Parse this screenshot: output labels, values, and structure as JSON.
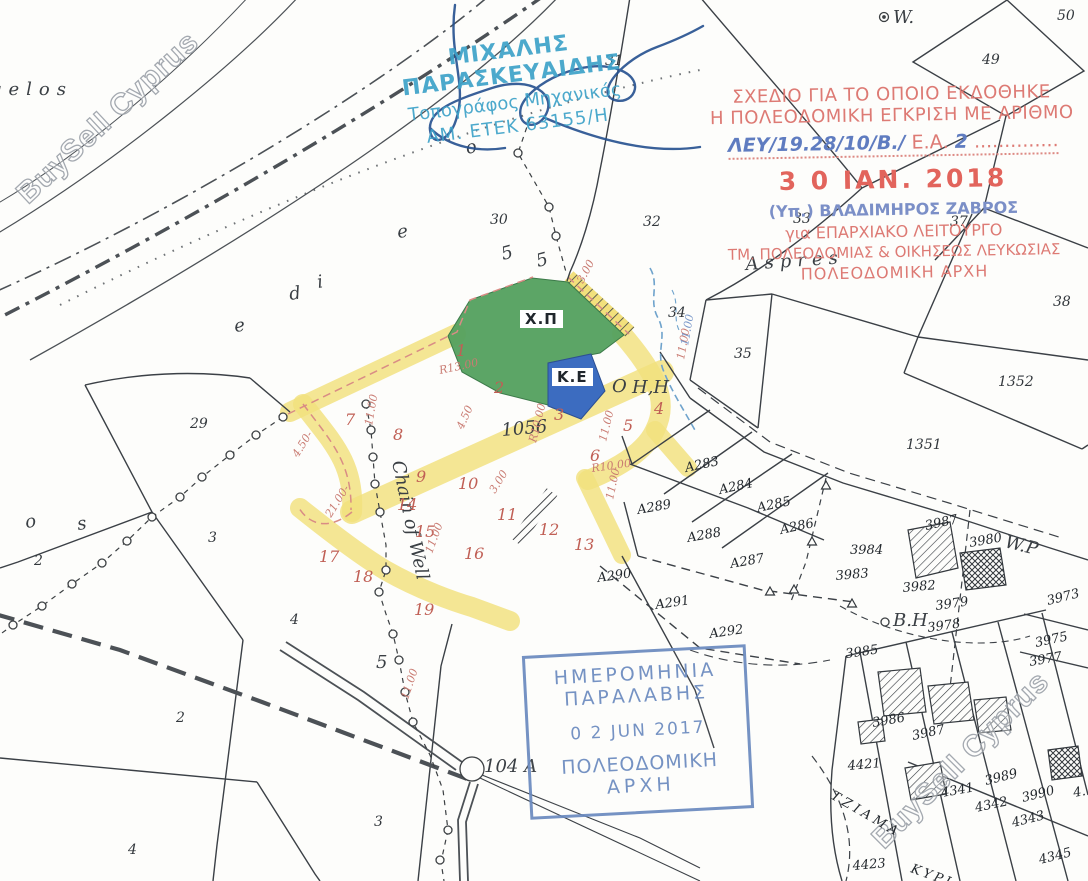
{
  "document_type": "cadastral-survey-plan",
  "watermarks": {
    "top_left": "BuySell Cyprus",
    "bottom_right": "BuySell Cyprus"
  },
  "surveyor_stamp": {
    "name": "ΜΙΧΑΛΗΣ ΠΑΡΑΣΚΕΥΑΙΔΗΣ",
    "title": "Τοπογράφος Μηχανικός",
    "registration": "ΑΜ. ΕΤΕΚ 63155/Η",
    "color": "#3ea2c9"
  },
  "approval_stamp": {
    "line1": "ΣΧΕΔΙΟ ΓΙΑ ΤΟ ΟΠΟΙΟ ΕΚΔΟΘΗΚΕ",
    "line2": "Η ΠΟΛΕΟΔΟΜΙΚΗ ΕΓΚΡΙΣΗ ΜΕ ΑΡΙΘΜΟ",
    "reference_handwritten": "ΛΕΥ/19.28/10/Β./",
    "reference_label": "Ε.Α.",
    "reference_number": "2",
    "reference_dots": "..............",
    "date": "3 0 ΙΑΝ. 2018",
    "signed_by": "(Υπ.) ΒΛΑΔΙΜΗΡΟΣ ΖΑΒΡΟΣ",
    "for_line": "για ΕΠΑΡΧΙΑΚΟ ΛΕΙΤΟΥΡΓΟ",
    "dept_line": "ΤΜ. ΠΟΛΕΟΔΟΜΙΑΣ & ΟΙΚΗΣΕΩΣ ΛΕΥΚΩΣΙΑΣ",
    "authority": "ΠΟΛΕΟΔΟΜΙΚΗ ΑΡΧΗ",
    "red": "#dd7a74",
    "blue": "#7b8fc7"
  },
  "receipt_stamp": {
    "line1": "ΗΜΕΡΟΜΗΝΙΑ",
    "line2": "ΠΑΡΑΛΑΒΗΣ",
    "date": "0 2 JUN 2017",
    "line3": "ΠΟΛΕΟΔΟΜΙΚΗ",
    "line4": "ΑΡΧΗ",
    "color": "#6a8abf"
  },
  "zones": {
    "green_label": "Χ.Π",
    "blue_label": "Κ.Ε",
    "green_color": "#53a05e",
    "blue_color": "#3c6cc0",
    "road_highlight_color": "#f2e07c",
    "plot_number_color": "#c05f55"
  },
  "map_labels": [
    {
      "text": "gelos",
      "x": -10,
      "y": 95,
      "cls": "name",
      "s": 23,
      "ls": 7
    },
    {
      "text": "o",
      "x": 26,
      "y": 528,
      "cls": "name",
      "rot": -8,
      "s": 20
    },
    {
      "text": "s",
      "x": 78,
      "y": 530,
      "cls": "name",
      "rot": -8,
      "s": 20
    },
    {
      "text": "e",
      "x": 235,
      "y": 332,
      "cls": "name",
      "rot": -8,
      "s": 19
    },
    {
      "text": "d",
      "x": 290,
      "y": 300,
      "cls": "name",
      "rot": -8,
      "s": 19
    },
    {
      "text": "i",
      "x": 318,
      "y": 288,
      "cls": "name",
      "rot": -8,
      "s": 17
    },
    {
      "text": "e",
      "x": 398,
      "y": 238,
      "cls": "name",
      "rot": -8,
      "s": 19
    },
    {
      "text": "o",
      "x": 467,
      "y": 154,
      "cls": "name",
      "rot": -12,
      "s": 19
    },
    {
      "text": "Aspres",
      "x": 746,
      "y": 270,
      "cls": "name",
      "rot": -4,
      "s": 21,
      "ls": 6
    },
    {
      "text": "1056",
      "x": 502,
      "y": 436,
      "cls": "name",
      "rot": -5,
      "s": 14
    },
    {
      "text": "Chain of Well",
      "x": 392,
      "y": 462,
      "cls": "name",
      "rot": 78,
      "s": 13
    },
    {
      "text": "104 A",
      "x": 484,
      "y": 772,
      "cls": "name",
      "s": 16
    },
    {
      "text": "W.",
      "x": 893,
      "y": 23,
      "cls": "name",
      "s": 14
    },
    {
      "text": "W.P",
      "x": 1004,
      "y": 547,
      "cls": "name",
      "rot": 14,
      "s": 12
    },
    {
      "text": "B.H",
      "x": 893,
      "y": 626,
      "cls": "name",
      "s": 11
    },
    {
      "text": "O",
      "x": 612,
      "y": 392,
      "cls": "name",
      "s": 17
    },
    {
      "text": "H,H",
      "x": 632,
      "y": 393,
      "cls": "name",
      "s": 12
    },
    {
      "text": "5",
      "x": 503,
      "y": 260,
      "cls": "name",
      "rot": -15,
      "s": 12
    },
    {
      "text": "5",
      "x": 538,
      "y": 267,
      "cls": "name",
      "rot": -15,
      "s": 12
    },
    {
      "text": "5",
      "x": 376,
      "y": 668,
      "cls": "name",
      "s": 13
    },
    {
      "text": "31",
      "x": 605,
      "y": 65,
      "cls": "blk",
      "s": 10
    },
    {
      "text": "50",
      "x": 1057,
      "y": 20,
      "cls": "blk",
      "s": 13
    },
    {
      "text": "49",
      "x": 982,
      "y": 64,
      "cls": "blk",
      "s": 15
    },
    {
      "text": "30",
      "x": 490,
      "y": 224,
      "cls": "blk"
    },
    {
      "text": "32",
      "x": 643,
      "y": 226,
      "cls": "blk"
    },
    {
      "text": "33",
      "x": 793,
      "y": 223,
      "cls": "blk",
      "s": 11
    },
    {
      "text": "37",
      "x": 950,
      "y": 226,
      "cls": "blk",
      "s": 11
    },
    {
      "text": "38",
      "x": 1053,
      "y": 306,
      "cls": "blk",
      "s": 13
    },
    {
      "text": "34",
      "x": 668,
      "y": 317,
      "cls": "blk",
      "s": 12
    },
    {
      "text": "35",
      "x": 734,
      "y": 358,
      "cls": "blk",
      "s": 15
    },
    {
      "text": "1352",
      "x": 998,
      "y": 386,
      "cls": "blk",
      "s": 15
    },
    {
      "text": "1351",
      "x": 906,
      "y": 449,
      "cls": "blk",
      "s": 14
    },
    {
      "text": "29",
      "x": 190,
      "y": 428,
      "cls": "blk"
    },
    {
      "text": "2",
      "x": 34,
      "y": 565,
      "cls": "blk",
      "s": 13
    },
    {
      "text": "3",
      "x": 208,
      "y": 542,
      "cls": "blk",
      "s": 13
    },
    {
      "text": "4",
      "x": 290,
      "y": 624,
      "cls": "blk",
      "s": 13
    },
    {
      "text": "2",
      "x": 176,
      "y": 722,
      "cls": "blk"
    },
    {
      "text": "3",
      "x": 374,
      "y": 826,
      "cls": "blk"
    },
    {
      "text": "4",
      "x": 128,
      "y": 854,
      "cls": "blk"
    },
    {
      "text": "1",
      "x": 456,
      "y": 356,
      "cls": "red"
    },
    {
      "text": "2",
      "x": 494,
      "y": 393,
      "cls": "red"
    },
    {
      "text": "3",
      "x": 554,
      "y": 420,
      "cls": "red"
    },
    {
      "text": "4",
      "x": 654,
      "y": 414,
      "cls": "red"
    },
    {
      "text": "5",
      "x": 623,
      "y": 431,
      "cls": "red"
    },
    {
      "text": "6",
      "x": 590,
      "y": 461,
      "cls": "red"
    },
    {
      "text": "7",
      "x": 345,
      "y": 425,
      "cls": "red"
    },
    {
      "text": "8",
      "x": 393,
      "y": 440,
      "cls": "red"
    },
    {
      "text": "9",
      "x": 416,
      "y": 482,
      "cls": "red"
    },
    {
      "text": "10",
      "x": 458,
      "y": 489,
      "cls": "red"
    },
    {
      "text": "11",
      "x": 497,
      "y": 520,
      "cls": "red"
    },
    {
      "text": "12",
      "x": 539,
      "y": 535,
      "cls": "red"
    },
    {
      "text": "13",
      "x": 574,
      "y": 550,
      "cls": "red"
    },
    {
      "text": "14",
      "x": 397,
      "y": 510,
      "cls": "red"
    },
    {
      "text": "15",
      "x": 415,
      "y": 537,
      "cls": "red"
    },
    {
      "text": "16",
      "x": 464,
      "y": 559,
      "cls": "red"
    },
    {
      "text": "17",
      "x": 319,
      "y": 562,
      "cls": "red"
    },
    {
      "text": "18",
      "x": 353,
      "y": 582,
      "cls": "red"
    },
    {
      "text": "19",
      "x": 414,
      "y": 615,
      "cls": "red"
    },
    {
      "text": "R13.00",
      "x": 440,
      "y": 374,
      "cls": "dim",
      "rot": -12
    },
    {
      "text": "R10.00",
      "x": 536,
      "y": 443,
      "cls": "dim",
      "rot": -76
    },
    {
      "text": "3.00",
      "x": 583,
      "y": 284,
      "cls": "dim",
      "rot": -62
    },
    {
      "text": "11.00",
      "x": 684,
      "y": 360,
      "cls": "dim",
      "rot": -80
    },
    {
      "text": "4.50",
      "x": 463,
      "y": 430,
      "cls": "dim",
      "rot": -66
    },
    {
      "text": "4.50-",
      "x": 298,
      "y": 458,
      "cls": "dim",
      "rot": -58
    },
    {
      "text": "11.00",
      "x": 372,
      "y": 426,
      "cls": "dim",
      "rot": -80
    },
    {
      "text": "11.00",
      "x": 606,
      "y": 442,
      "cls": "dim",
      "rot": -76
    },
    {
      "text": "R10.00",
      "x": 592,
      "y": 472,
      "cls": "dim",
      "rot": -8
    },
    {
      "text": "11.00",
      "x": 613,
      "y": 500,
      "cls": "dim",
      "rot": -78
    },
    {
      "text": "3.00",
      "x": 495,
      "y": 494,
      "cls": "dim",
      "rot": -58
    },
    {
      "text": "11.00",
      "x": 432,
      "y": 554,
      "cls": "dim",
      "rot": -70
    },
    {
      "text": "21.00-",
      "x": 331,
      "y": 518,
      "cls": "dim",
      "rot": -58
    },
    {
      "text": "11.00",
      "x": 408,
      "y": 700,
      "cls": "dim",
      "rot": -72
    },
    {
      "text": "11.00",
      "x": 688,
      "y": 346,
      "cls": "dimb",
      "rot": -80
    },
    {
      "text": "A283",
      "x": 686,
      "y": 472,
      "cls": "hand",
      "rot": -12
    },
    {
      "text": "A284",
      "x": 720,
      "y": 494,
      "cls": "hand",
      "rot": -12
    },
    {
      "text": "A285",
      "x": 758,
      "y": 512,
      "cls": "hand",
      "rot": -12
    },
    {
      "text": "A286",
      "x": 781,
      "y": 534,
      "cls": "hand",
      "rot": -12
    },
    {
      "text": "A287",
      "x": 731,
      "y": 568,
      "cls": "hand",
      "rot": -10
    },
    {
      "text": "A288",
      "x": 688,
      "y": 542,
      "cls": "hand",
      "rot": -10
    },
    {
      "text": "A289",
      "x": 638,
      "y": 514,
      "cls": "hand",
      "rot": -10
    },
    {
      "text": "A290",
      "x": 598,
      "y": 582,
      "cls": "hand",
      "rot": -8
    },
    {
      "text": "A291",
      "x": 656,
      "y": 609,
      "cls": "hand",
      "rot": -8
    },
    {
      "text": "A292",
      "x": 710,
      "y": 638,
      "cls": "hand",
      "rot": -8
    },
    {
      "text": "3984",
      "x": 850,
      "y": 554,
      "cls": "hand",
      "s": 14
    },
    {
      "text": "3983",
      "x": 836,
      "y": 580,
      "cls": "hand",
      "rot": -5,
      "s": 13
    },
    {
      "text": "3987",
      "x": 926,
      "y": 530,
      "cls": "hand",
      "rot": -12
    },
    {
      "text": "3980",
      "x": 970,
      "y": 547,
      "cls": "hand",
      "rot": -10
    },
    {
      "text": "3982",
      "x": 903,
      "y": 592,
      "cls": "hand",
      "rot": -5
    },
    {
      "text": "3979",
      "x": 936,
      "y": 610,
      "cls": "hand",
      "rot": -8
    },
    {
      "text": "3978",
      "x": 928,
      "y": 632,
      "cls": "hand",
      "rot": -8
    },
    {
      "text": "3973",
      "x": 1048,
      "y": 605,
      "cls": "hand",
      "rot": -14
    },
    {
      "text": "3975",
      "x": 1036,
      "y": 647,
      "cls": "hand",
      "rot": -12
    },
    {
      "text": "3977",
      "x": 1030,
      "y": 666,
      "cls": "hand",
      "rot": -10
    },
    {
      "text": "3985",
      "x": 846,
      "y": 658,
      "cls": "hand",
      "rot": -8
    },
    {
      "text": "3986",
      "x": 873,
      "y": 727,
      "cls": "hand",
      "rot": -10
    },
    {
      "text": "3987",
      "x": 913,
      "y": 740,
      "cls": "hand",
      "rot": -12
    },
    {
      "text": "3989",
      "x": 986,
      "y": 785,
      "cls": "hand",
      "rot": -14
    },
    {
      "text": "3990",
      "x": 1023,
      "y": 802,
      "cls": "hand",
      "rot": -14
    },
    {
      "text": "4341",
      "x": 942,
      "y": 797,
      "cls": "hand",
      "rot": -10
    },
    {
      "text": "4342",
      "x": 976,
      "y": 812,
      "cls": "hand",
      "rot": -12
    },
    {
      "text": "4343",
      "x": 1013,
      "y": 827,
      "cls": "hand",
      "rot": -14
    },
    {
      "text": "4345",
      "x": 1040,
      "y": 864,
      "cls": "hand",
      "rot": -14
    },
    {
      "text": "4421",
      "x": 848,
      "y": 770,
      "cls": "hand",
      "rot": -5
    },
    {
      "text": "4423",
      "x": 853,
      "y": 870,
      "cls": "hand",
      "rot": -5
    },
    {
      "text": "4.",
      "x": 1074,
      "y": 797,
      "cls": "hand",
      "rot": -10,
      "s": 12
    },
    {
      "text": "ΤΖΙΑΜΑ",
      "x": 830,
      "y": 798,
      "cls": "hand",
      "rot": 30,
      "s": 11,
      "ls": 4
    },
    {
      "text": "ΚΥΡΙ",
      "x": 910,
      "y": 872,
      "cls": "hand",
      "rot": 20,
      "s": 12,
      "ls": 3
    }
  ]
}
